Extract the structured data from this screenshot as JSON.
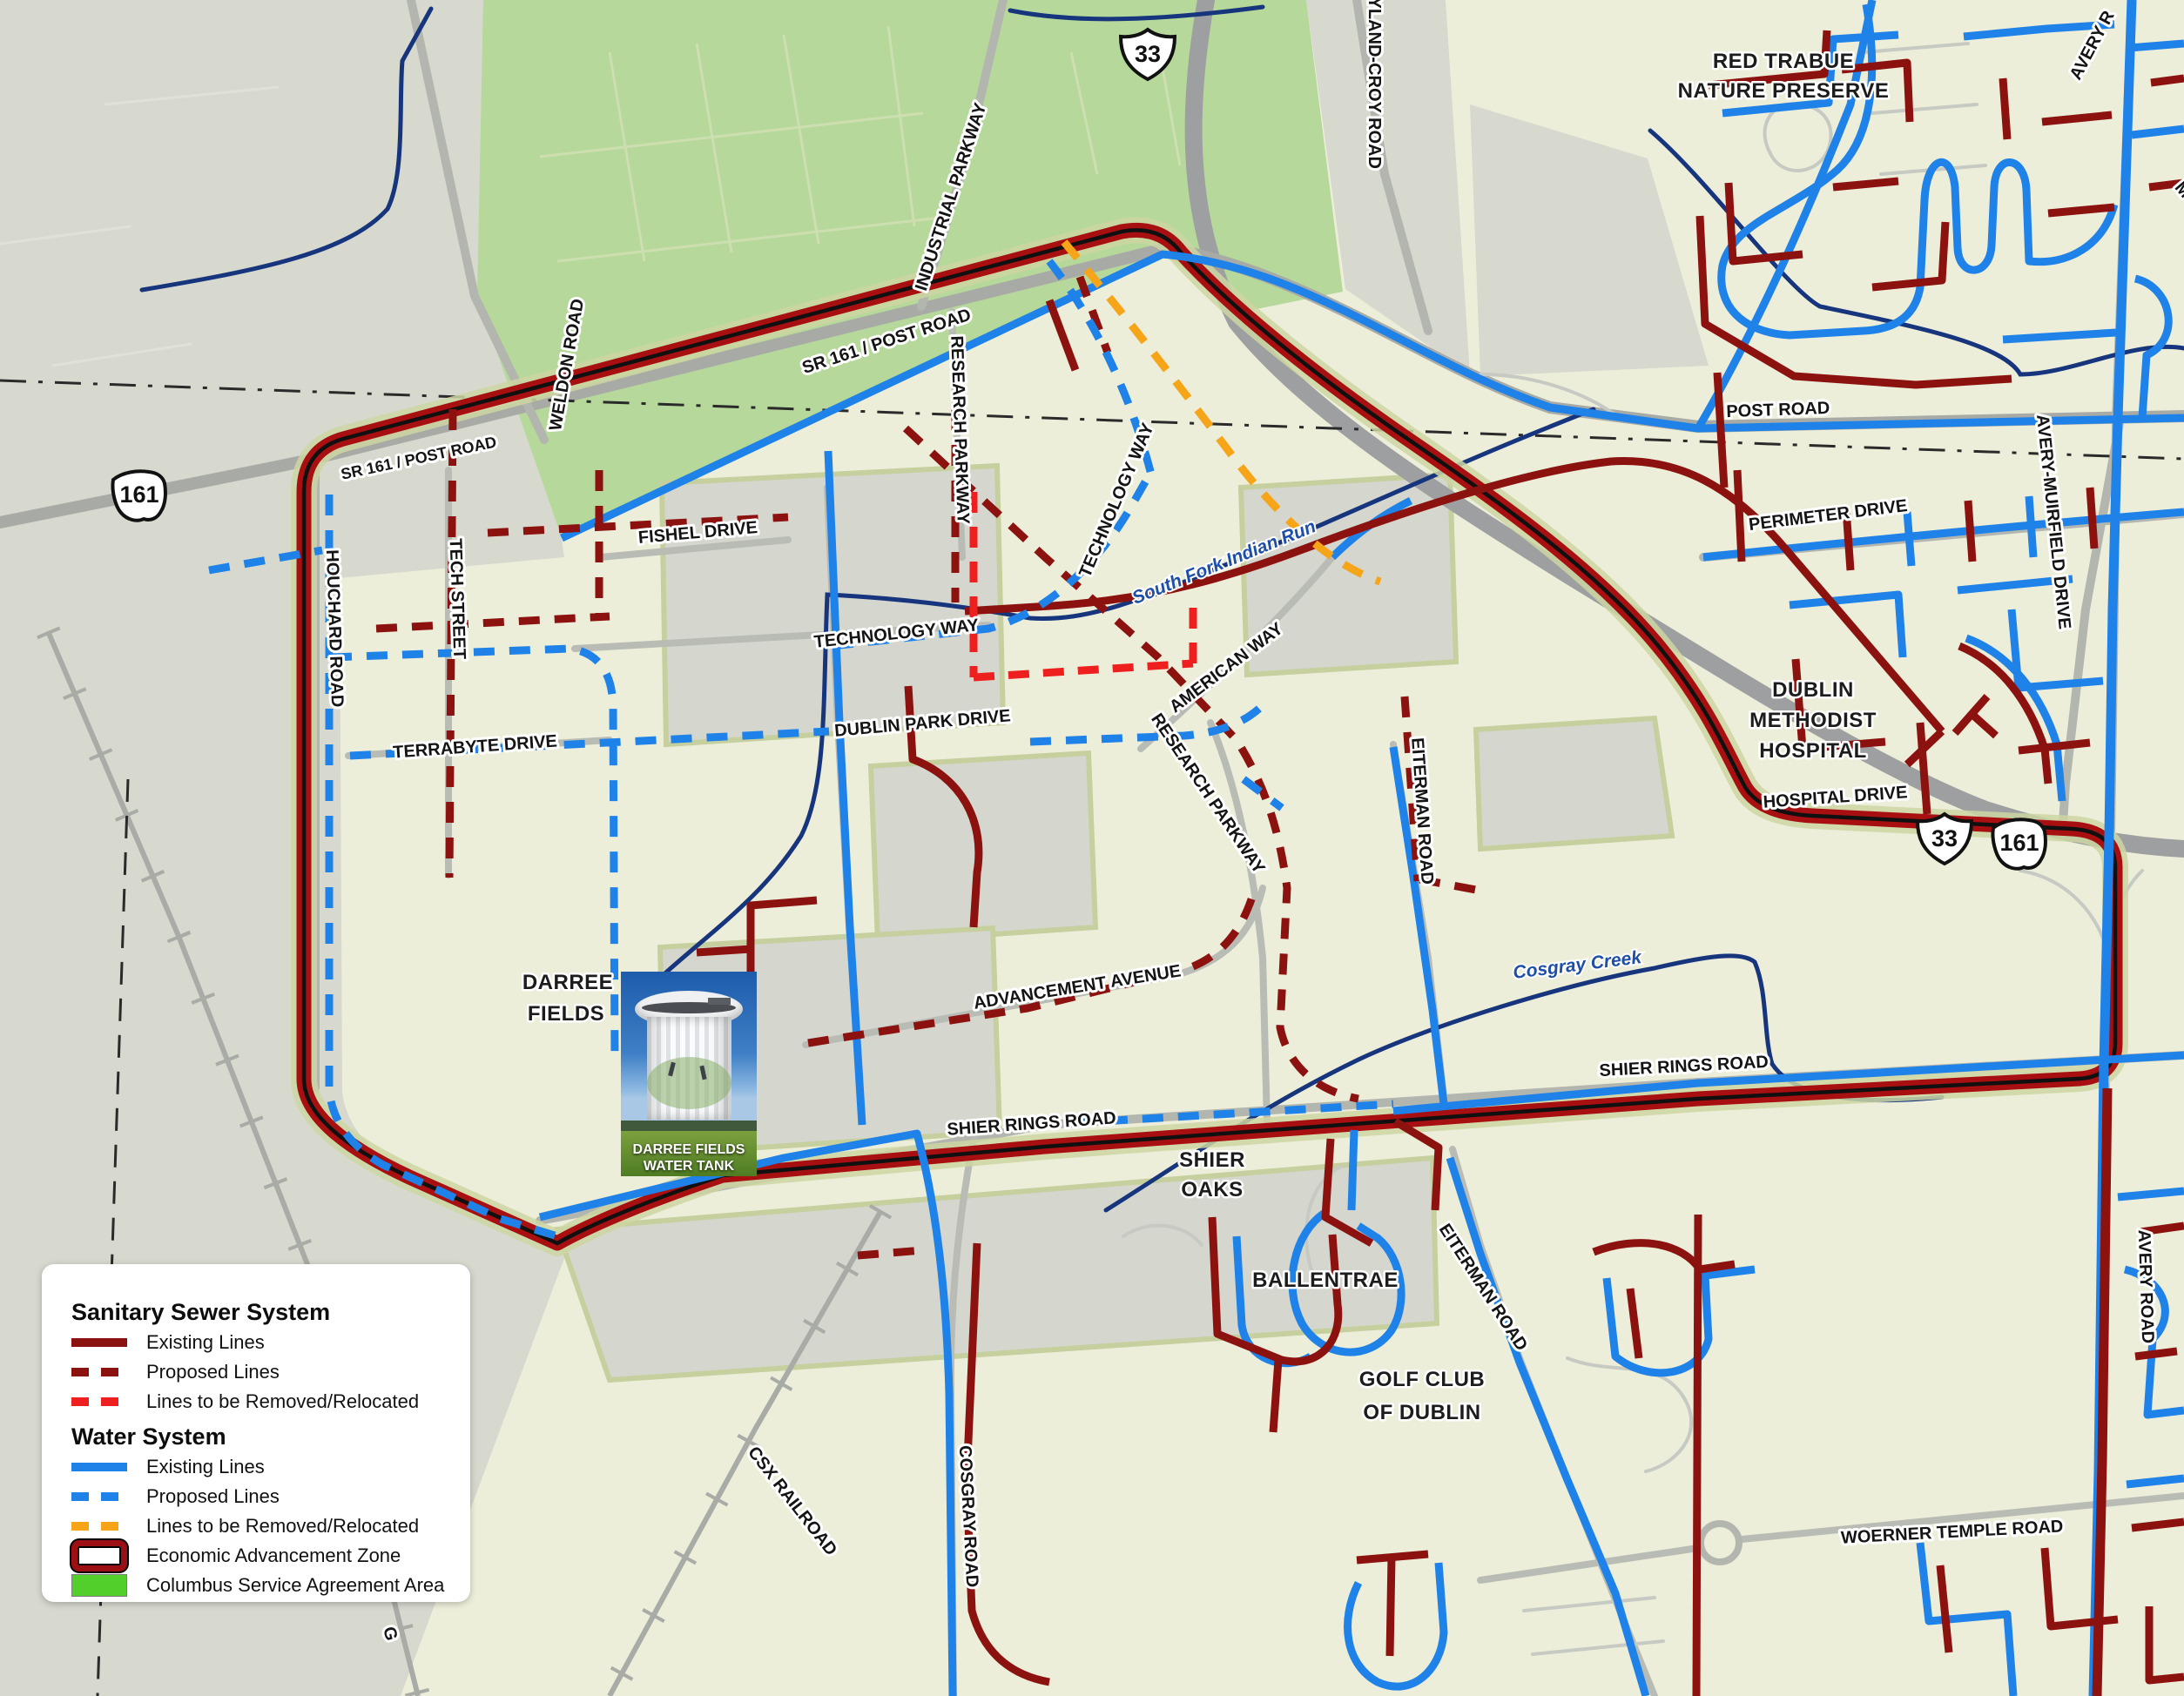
{
  "legend": {
    "sewer_title": "Sanitary Sewer System",
    "sewer_items": [
      "Existing Lines",
      "Proposed Lines",
      "Lines to be Removed/Relocated"
    ],
    "water_title": "Water System",
    "water_items": [
      "Existing Lines",
      "Proposed Lines",
      "Lines to be Removed/Relocated"
    ],
    "zone_label": "Economic Advancement Zone",
    "columbus_label": "Columbus Service Agreement Area"
  },
  "colors": {
    "sewer_existing": "#8c1210",
    "sewer_removed": "#ee1f1f",
    "water_existing": "#1e82e8",
    "water_removed": "#f6a418",
    "zone_border": "#a80f10",
    "columbus_area": "#52cf2b"
  },
  "shields": [
    {
      "route": "33"
    },
    {
      "route": "161"
    },
    {
      "route": "33"
    },
    {
      "route": "161"
    }
  ],
  "photo": {
    "caption1": "DARREE FIELDS",
    "caption2": "WATER TANK"
  },
  "labels": [
    {
      "text": "INDUSTRIAL PARKWAY"
    },
    {
      "text": "HYLAND-CROY ROAD"
    },
    {
      "text": "RED TRABUE"
    },
    {
      "text": "NATURE PRESERVE"
    },
    {
      "text": "AVERY R"
    },
    {
      "text": "WELDON ROAD"
    },
    {
      "text": "SR 161 / POST ROAD"
    },
    {
      "text": "SR 161 / POST ROAD"
    },
    {
      "text": "HOUCHARD ROAD"
    },
    {
      "text": "TECH STREET"
    },
    {
      "text": "FISHEL DRIVE"
    },
    {
      "text": "RESEARCH PARKWAY"
    },
    {
      "text": "TECHNOLOGY WAY"
    },
    {
      "text": "TECHNOLOGY WAY"
    },
    {
      "text": "TERRABYTE DRIVE"
    },
    {
      "text": "DUBLIN PARK DRIVE"
    },
    {
      "text": "AMERICAN WAY"
    },
    {
      "text": "RESEARCH PARKWAY"
    },
    {
      "text": "EITERMAN ROAD"
    },
    {
      "text": "South Fork Indian Run"
    },
    {
      "text": "POST ROAD"
    },
    {
      "text": "PERIMETER DRIVE"
    },
    {
      "text": "AVERY-MUIRFIELD  DRIVE"
    },
    {
      "text": "DUBLIN"
    },
    {
      "text": "METHODIST"
    },
    {
      "text": "HOSPITAL"
    },
    {
      "text": "HOSPITAL   DRIVE"
    },
    {
      "text": "DARREE"
    },
    {
      "text": "FIELDS"
    },
    {
      "text": "ADVANCEMENT AVENUE"
    },
    {
      "text": "Cosgray Creek"
    },
    {
      "text": "SHIER RINGS ROAD"
    },
    {
      "text": "SHIER RINGS   ROAD"
    },
    {
      "text": "SHIER"
    },
    {
      "text": "OAKS"
    },
    {
      "text": "BALLENTRAE"
    },
    {
      "text": "GOLF CLUB"
    },
    {
      "text": "OF DUBLIN"
    },
    {
      "text": "EITERMAN ROAD"
    },
    {
      "text": "CSX RAILROAD"
    },
    {
      "text": "COSGRAY ROAD"
    },
    {
      "text": "WOERNER  TEMPLE  ROAD"
    },
    {
      "text": "AVERY ROAD"
    },
    {
      "text": "G"
    },
    {
      "text": "M"
    }
  ]
}
